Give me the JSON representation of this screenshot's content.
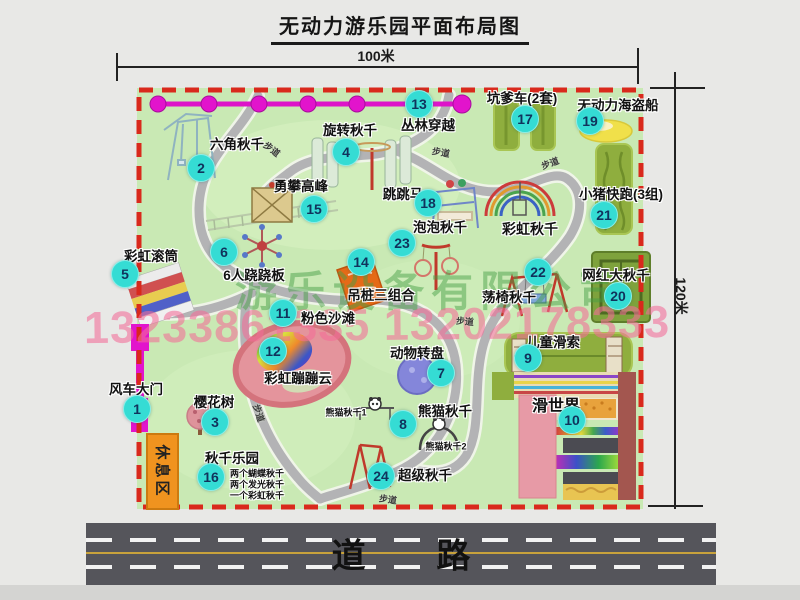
{
  "title": "无动力游乐园平面布局图",
  "dimensions": {
    "width_label": "100米",
    "height_label": "120米"
  },
  "road": {
    "label": "道 路"
  },
  "watermark": {
    "company": "游乐设备有限公司",
    "phone": "13233861335 13202178333"
  },
  "rest_area": {
    "label": "休息区"
  },
  "map": {
    "path_label_text": "步道",
    "attractions": [
      {
        "num": "1",
        "name": "风车大门",
        "lx": 136,
        "ly": 388,
        "bx": 137,
        "by": 409
      },
      {
        "num": "2",
        "name": "六角秋千",
        "lx": 237,
        "ly": 143,
        "bx": 201,
        "by": 168
      },
      {
        "num": "3",
        "name": "樱花树",
        "lx": 214,
        "ly": 401,
        "bx": 215,
        "by": 422
      },
      {
        "num": "4",
        "name": "旋转秋千",
        "lx": 350,
        "ly": 129,
        "bx": 346,
        "by": 152
      },
      {
        "num": "5",
        "name": "彩虹滚筒",
        "lx": 151,
        "ly": 255,
        "bx": 125,
        "by": 274
      },
      {
        "num": "6",
        "name": "6人跷跷板",
        "lx": 254,
        "ly": 274,
        "bx": 224,
        "by": 252
      },
      {
        "num": "7",
        "name": "动物转盘",
        "lx": 417,
        "ly": 352,
        "bx": 441,
        "by": 373
      },
      {
        "num": "8",
        "name": "熊猫秋千",
        "lx": 445,
        "ly": 410,
        "bx": 403,
        "by": 424
      },
      {
        "num": "9",
        "name": "儿童滑索",
        "lx": 553,
        "ly": 341,
        "bx": 528,
        "by": 358
      },
      {
        "num": "10",
        "name": "滑世界",
        "lx": 556,
        "ly": 404,
        "bx": 572,
        "by": 420,
        "size": 16
      },
      {
        "num": "11",
        "name": "粉色沙滩",
        "lx": 328,
        "ly": 317,
        "bx": 283,
        "by": 313
      },
      {
        "num": "12",
        "name": "彩虹蹦蹦云",
        "lx": 298,
        "ly": 377,
        "bx": 273,
        "by": 351
      },
      {
        "num": "13",
        "name": "丛林穿越",
        "lx": 428,
        "ly": 124,
        "bx": 419,
        "by": 104
      },
      {
        "num": "14",
        "name": "吊桩三组合",
        "lx": 381,
        "ly": 294,
        "bx": 361,
        "by": 262
      },
      {
        "num": "15",
        "name": "勇攀高峰",
        "lx": 301,
        "ly": 185,
        "bx": 314,
        "by": 209
      },
      {
        "num": "16",
        "name": "秋千乐园",
        "lx": 232,
        "ly": 457,
        "bx": 211,
        "by": 477
      },
      {
        "num": "17",
        "name": "坑爹车(2套)",
        "lx": 522,
        "ly": 97,
        "bx": 525,
        "by": 119
      },
      {
        "num": "18",
        "name": "跳跳马",
        "lx": 403,
        "ly": 193,
        "bx": 428,
        "by": 203
      },
      {
        "num": "19",
        "name": "无动力海盗船",
        "lx": 618,
        "ly": 104,
        "bx": 590,
        "by": 121
      },
      {
        "num": "20",
        "name": "网红大秋千",
        "lx": 616,
        "ly": 274,
        "bx": 618,
        "by": 296
      },
      {
        "num": "21",
        "name": "小猪快跑(3组)",
        "lx": 621,
        "ly": 193,
        "bx": 604,
        "by": 215
      },
      {
        "num": "22",
        "name": "荡椅秋千",
        "lx": 509,
        "ly": 296,
        "bx": 538,
        "by": 272
      },
      {
        "num": "23",
        "name": "泡泡秋千",
        "lx": 440,
        "ly": 226,
        "bx": 402,
        "by": 243
      },
      {
        "num": "24",
        "name": "超级秋千",
        "lx": 425,
        "ly": 474,
        "bx": 381,
        "by": 476
      }
    ],
    "extra_labels": [
      {
        "text": "彩虹秋千",
        "x": 530,
        "y": 229,
        "size": 14
      },
      {
        "text": "熊猫秋千1",
        "x": 346,
        "y": 412,
        "size": 9
      },
      {
        "text": "熊猫秋千2",
        "x": 446,
        "y": 446,
        "size": 9
      },
      {
        "text": "两个蝴蝶秋千",
        "x": 257,
        "y": 473,
        "size": 9
      },
      {
        "text": "两个发光秋千",
        "x": 257,
        "y": 484,
        "size": 9
      },
      {
        "text": "一个彩虹秋千",
        "x": 257,
        "y": 495,
        "size": 9
      }
    ],
    "path_labels": [
      {
        "x": 272,
        "y": 149,
        "rot": 38
      },
      {
        "x": 441,
        "y": 152,
        "rot": 10
      },
      {
        "x": 550,
        "y": 163,
        "rot": -20
      },
      {
        "x": 465,
        "y": 321,
        "rot": 5
      },
      {
        "x": 259,
        "y": 413,
        "rot": 72
      },
      {
        "x": 388,
        "y": 499,
        "rot": 8
      }
    ],
    "colors": {
      "map_green": "#c9e9b4",
      "border_red": "#d9291c",
      "badge_cyan": "#35dcd4",
      "zipline_magenta": "#dd13c9",
      "gate_magenta": "#e214cc",
      "rest_orange": "#f0931f",
      "road_gray": "#55555b",
      "olive_green": "#8fae3e",
      "pirate_yellow": "#f0e04a",
      "turntable_purple": "#8486da",
      "beach_pink": "#e4949c"
    }
  }
}
